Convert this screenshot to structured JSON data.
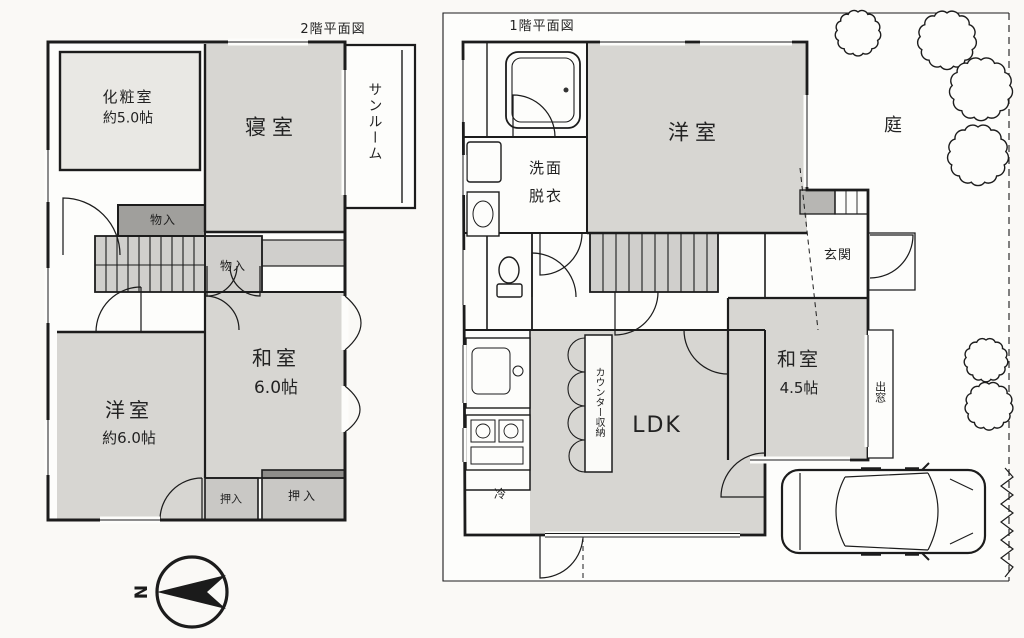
{
  "colors": {
    "wall_line": "#1c1c1c",
    "room_fill": "#d7d6d2",
    "service_fill": "#d0cfcc",
    "closet_fill": "#c9c8c5",
    "dark_storage_fill": "#a09f9c",
    "powder_room_fill": "#e9e8e4",
    "paper_white": "#fdfdfb"
  },
  "floor2": {
    "title": "2階平面図",
    "rooms": {
      "powder_room_name": "化粧室",
      "powder_room_size": "約5.0帖",
      "bedroom": "寝室",
      "sunroom": "サンルーム",
      "storage_upper": "物入",
      "storage_lower": "物入",
      "japanese_room_name": "和室",
      "japanese_room_size": "6.0帖",
      "western_room_name": "洋室",
      "western_room_size": "約6.0帖",
      "closet_small": "押入",
      "closet_large": "押入"
    },
    "compass_north": "N"
  },
  "floor1": {
    "title": "1階平面図",
    "rooms": {
      "washroom_line1": "洗面",
      "washroom_line2": "脱衣",
      "western_room": "洋室",
      "garden": "庭",
      "entrance": "玄関",
      "japanese_room_name": "和室",
      "japanese_room_size": "4.5帖",
      "bay_window": "出窓",
      "ldk": "LDK",
      "counter_storage": "カウンター収納",
      "refrigerator": "冷"
    }
  }
}
